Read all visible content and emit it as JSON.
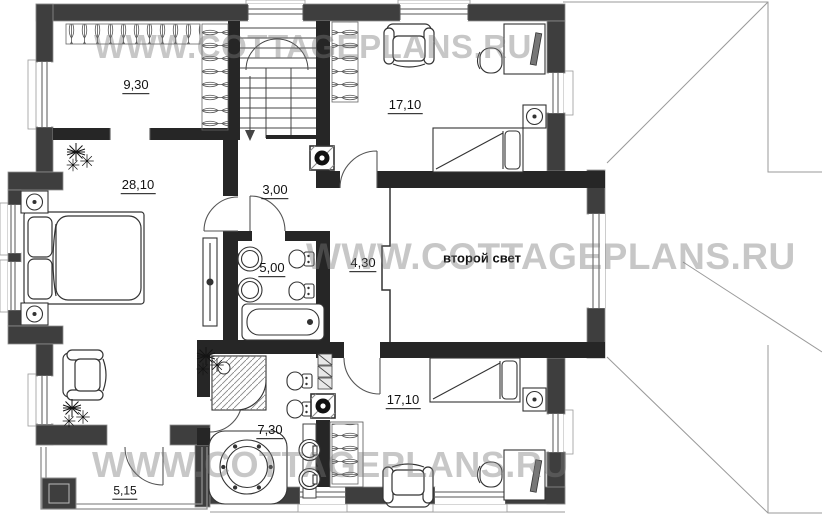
{
  "watermark": {
    "text": "WWW.COTTAGEPLANS.RU",
    "color": "#7a7a7a"
  },
  "plan": {
    "labels": {
      "wardrobe": "9,30",
      "master_bedroom": "28,10",
      "hall": "3,00",
      "bathroom_upper": "5,00",
      "gallery": "4,30",
      "void": "второй свет",
      "bedroom_top": "17,10",
      "bedroom_bottom": "17,10",
      "bathroom_lower": "7,30",
      "balcony": "5,15"
    },
    "colors": {
      "exterior_wall": "#3e3e3e",
      "interior_wall": "#262626",
      "roof_line": "#9a9a9a",
      "furniture_line": "#333333"
    }
  }
}
